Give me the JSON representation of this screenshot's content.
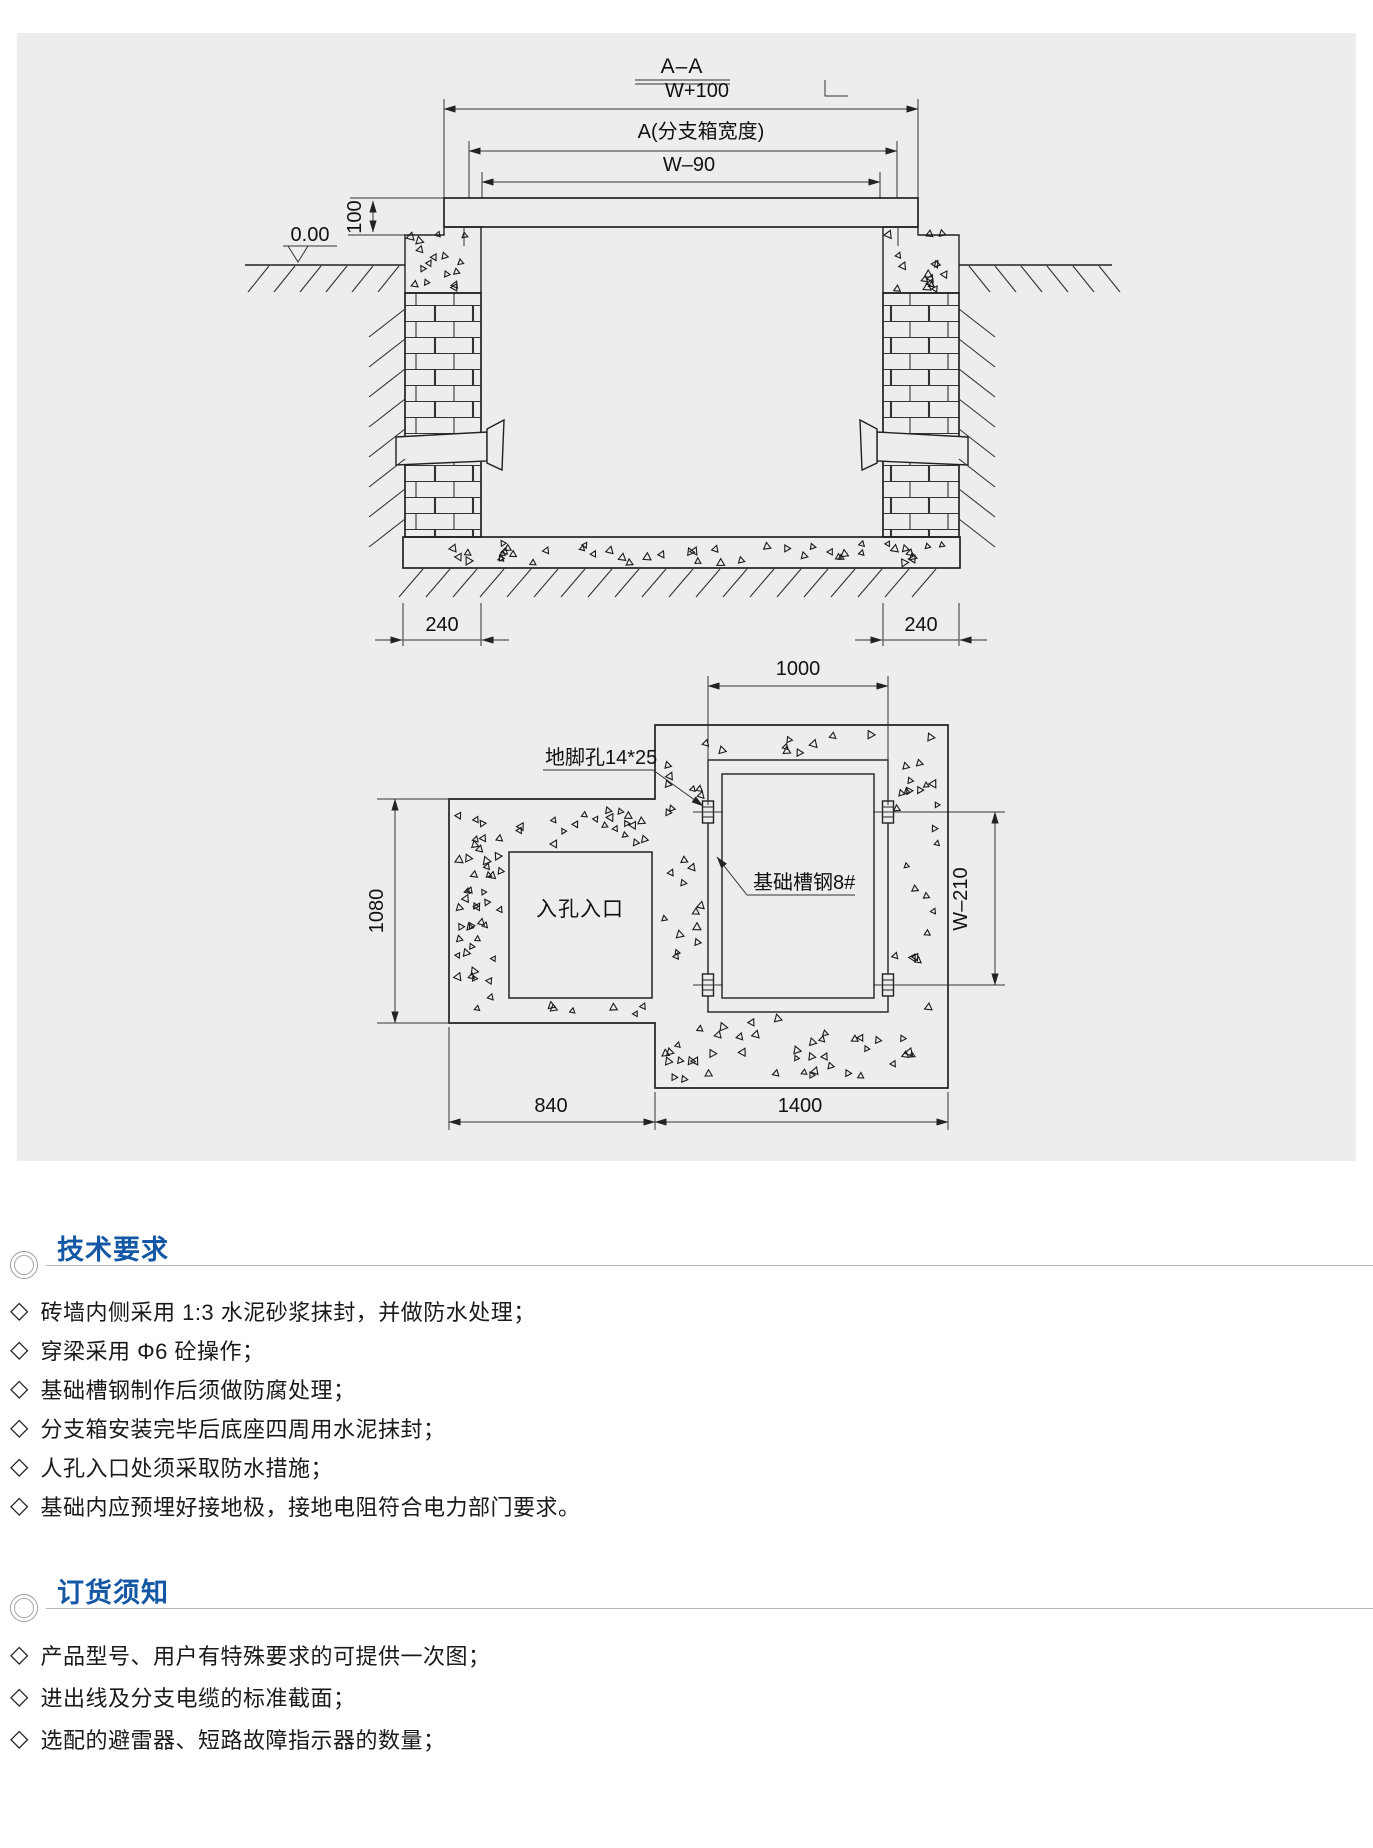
{
  "colors": {
    "panel": "#EDEDEE",
    "accent": "#1458A5",
    "line": "#222222",
    "rule": "#B8B8B8"
  },
  "bullet": "◇",
  "drawing": {
    "section_view": {
      "title": "A–A",
      "dim_w100": "W+100",
      "dim_a": "A(分支箱宽度)",
      "dim_w90": "W–90",
      "dim_100": "100",
      "level": "0.00",
      "dim_240_left": "240",
      "dim_240_right": "240"
    },
    "plan_view": {
      "dim_1000": "1000",
      "dim_1080": "1080",
      "dim_w210": "W–210",
      "dim_840": "840",
      "dim_1400": "1400",
      "label_anchor_hole": "地脚孔14*25",
      "label_channel_steel": "基础槽钢8#",
      "label_manhole": "入孔入口"
    }
  },
  "sections": [
    {
      "title": "技术要求",
      "items": [
        "砖墙内侧采用 1:3 水泥砂浆抹封，并做防水处理；",
        "穿梁采用 Φ6 砼操作；",
        "基础槽钢制作后须做防腐处理；",
        "分支箱安装完毕后底座四周用水泥抹封；",
        "人孔入口处须采取防水措施；",
        "基础内应预埋好接地极，接地电阻符合电力部门要求。"
      ]
    },
    {
      "title": "订货须知",
      "items": [
        "产品型号、用户有特殊要求的可提供一次图；",
        "进出线及分支电缆的标准截面；",
        "选配的避雷器、短路故障指示器的数量；"
      ]
    }
  ]
}
